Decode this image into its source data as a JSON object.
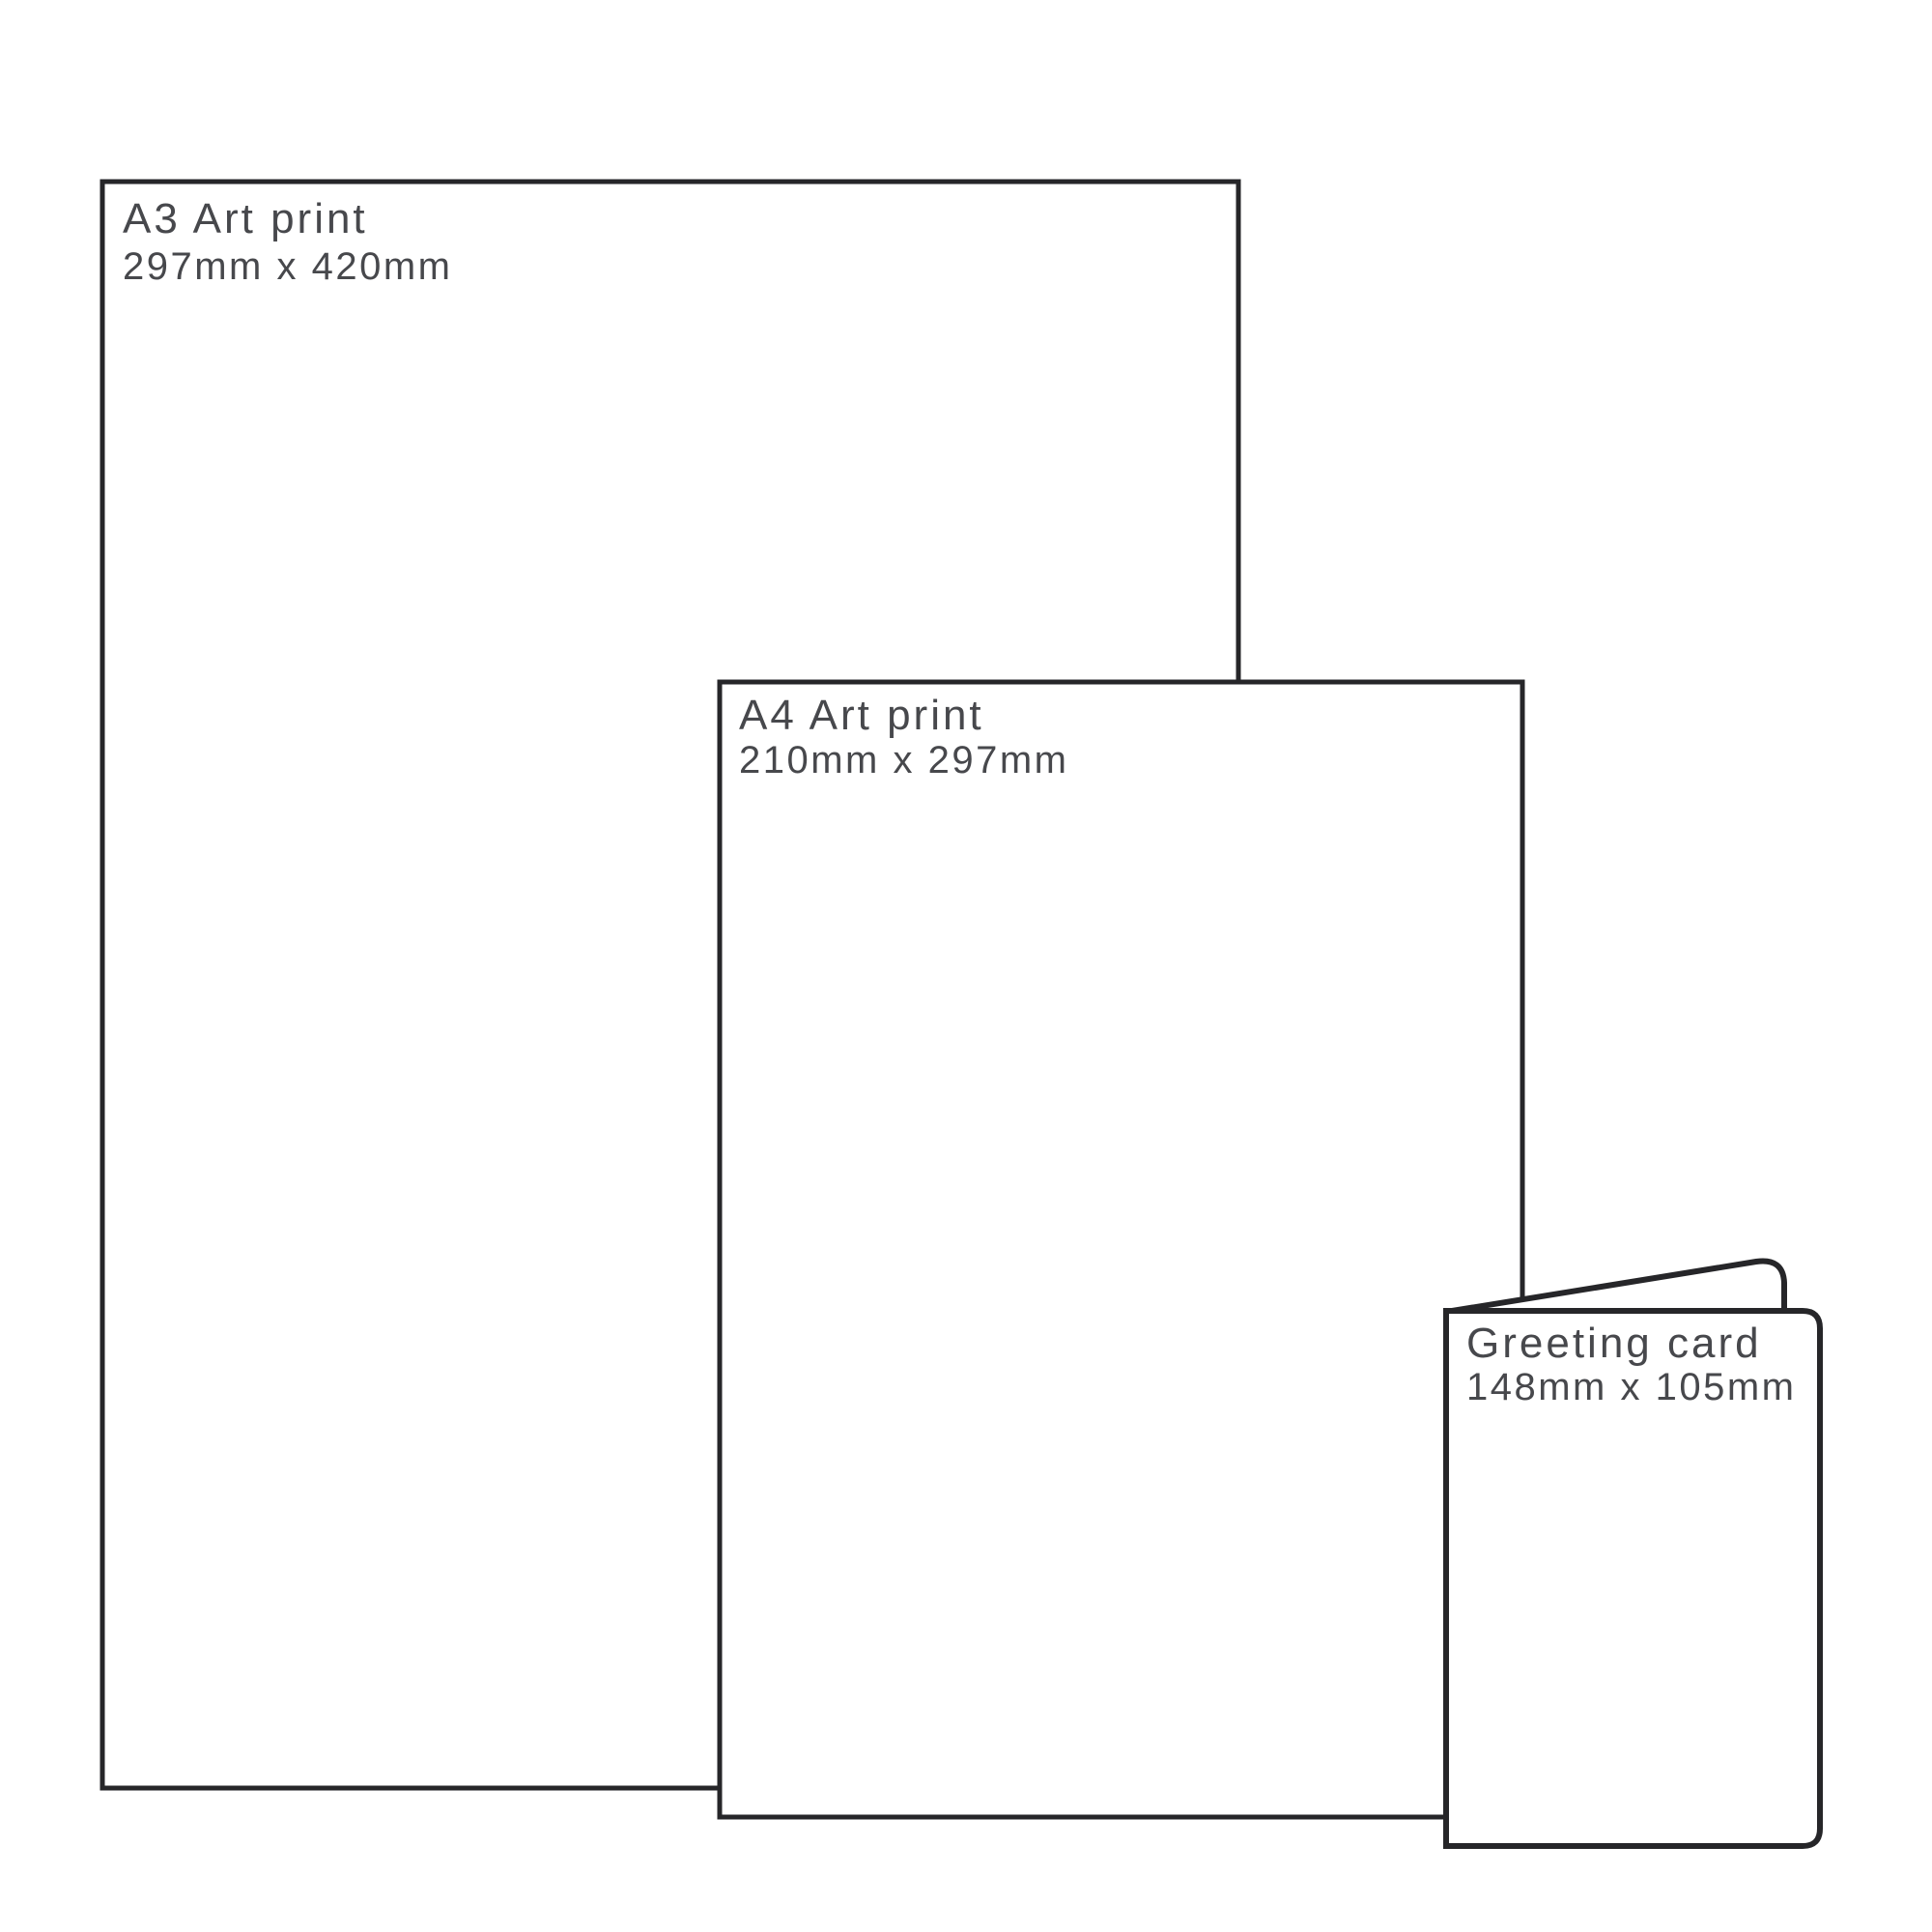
{
  "canvas": {
    "background": "#ffffff",
    "stroke_color": "#262629",
    "text_color": "#47484c"
  },
  "items": [
    {
      "id": "a3-art-print",
      "title": "A3 Art print",
      "dimensions": "297mm x 420mm"
    },
    {
      "id": "a4-art-print",
      "title": "A4 Art print",
      "dimensions": "210mm x 297mm"
    },
    {
      "id": "greeting-card",
      "title": "Greeting card",
      "dimensions": "148mm x 105mm"
    }
  ]
}
